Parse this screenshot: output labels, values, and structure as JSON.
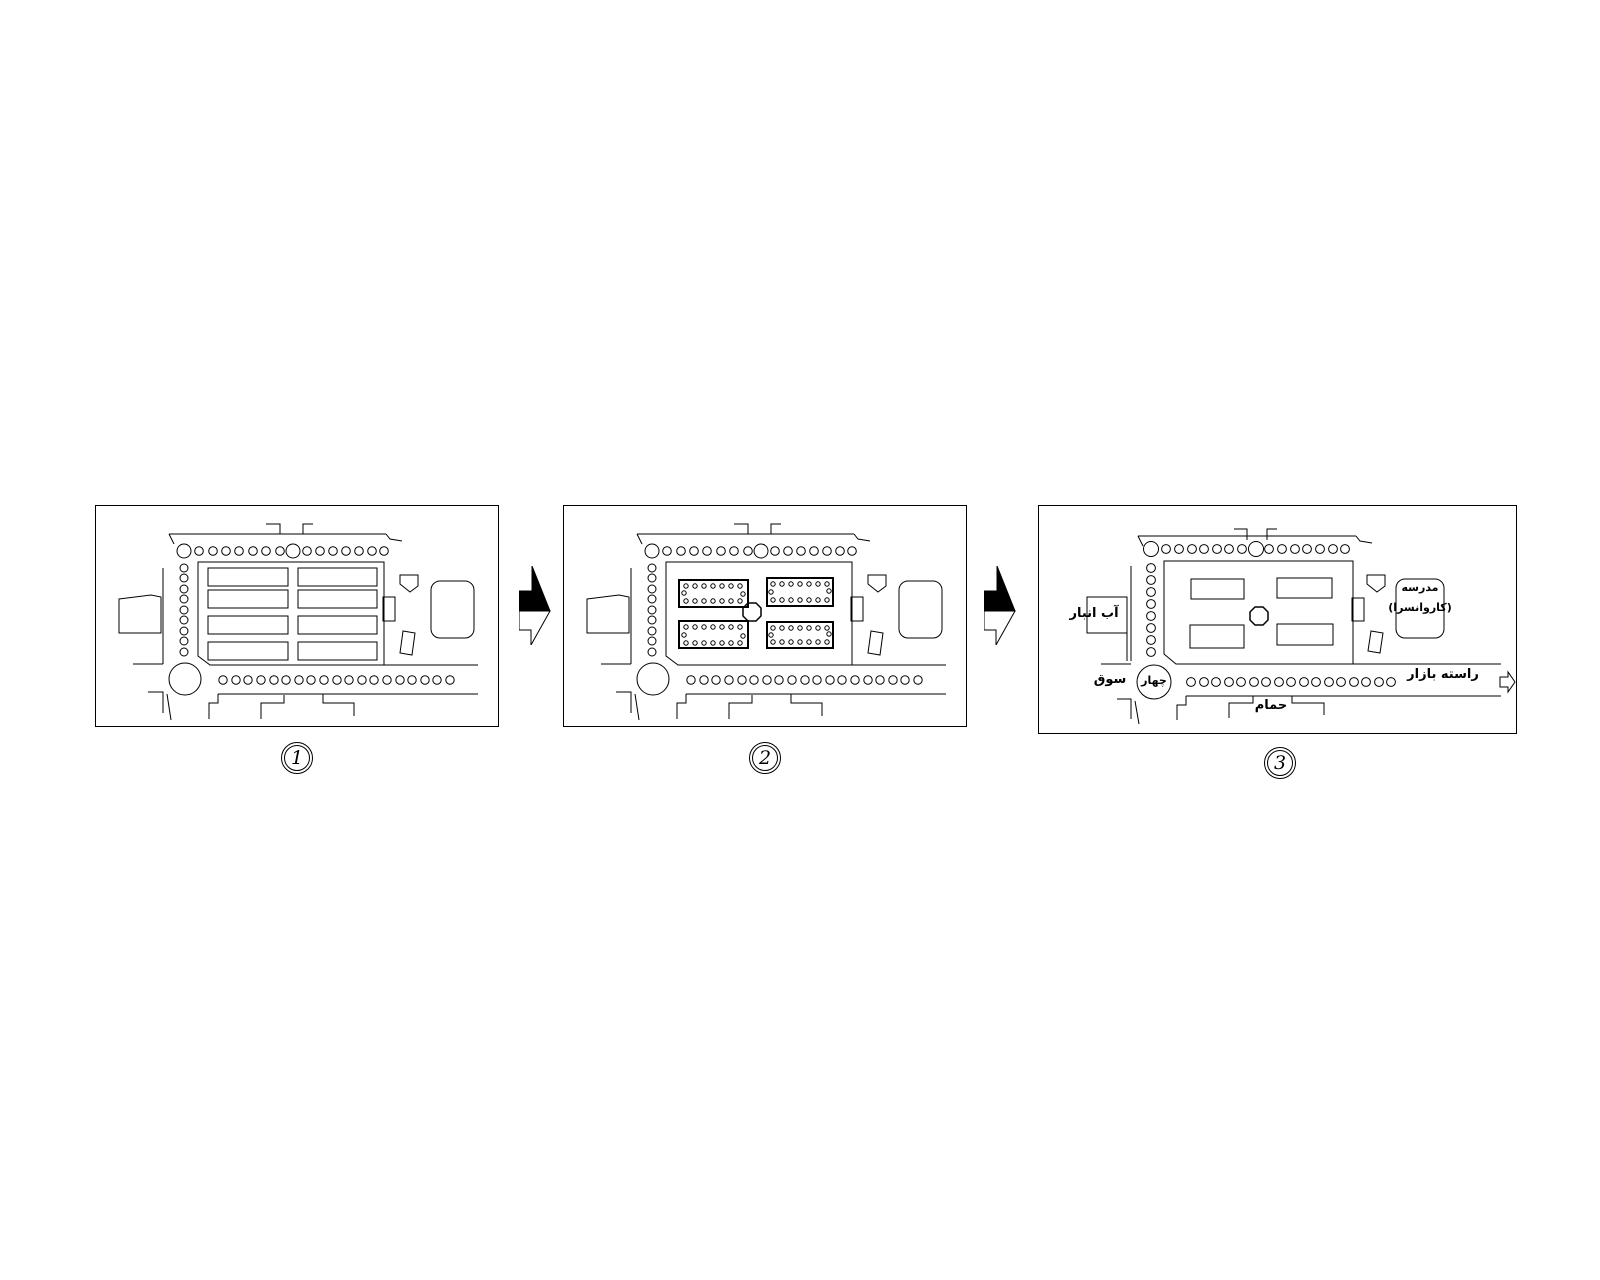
{
  "figure": {
    "type": "bazaar-evolution-diagram",
    "stages": 3,
    "colors": {
      "line": "#000000",
      "background": "#ffffff",
      "arrow_fill": "#000000"
    },
    "icons": {
      "stage_transition": "zigzag-right-arrow-half-filled",
      "bazaar_direction": "hollow-right-arrow"
    }
  },
  "panels": [
    {
      "number": "1",
      "labels": {}
    },
    {
      "number": "2",
      "labels": {}
    },
    {
      "number": "3",
      "labels": {
        "water_reservoir": "آب انبار",
        "crossroads_inner": "چهار",
        "crossroads_outer": "سوق",
        "school_line1": "مدرسه",
        "school_line2": "(کاروانسرا)",
        "bazaar_spine": "راسته بازار",
        "bathhouse": "حمام"
      }
    }
  ]
}
